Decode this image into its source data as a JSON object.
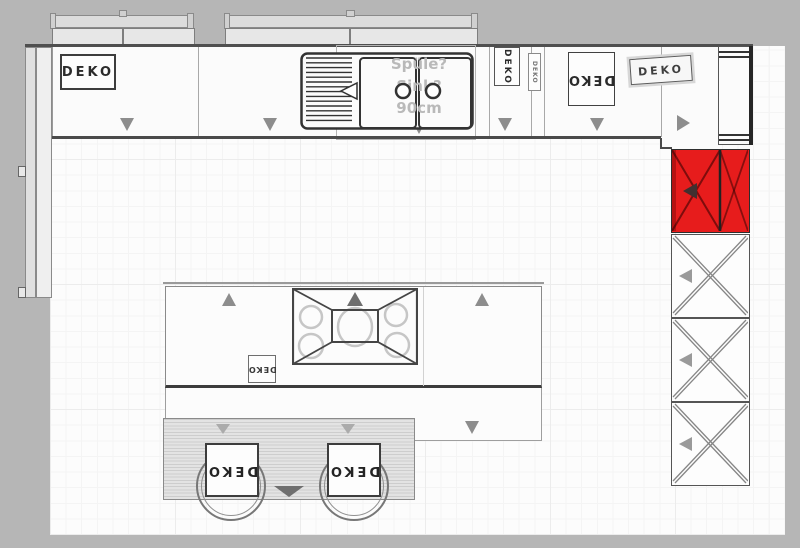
{
  "labels": {
    "deko": "DEKO"
  },
  "annotations": {
    "sink": {
      "line1": "Spüle?",
      "line2": "Sink?",
      "line3": "90cm"
    }
  },
  "colors": {
    "highlight_red": "#e71c1c",
    "exterior_gray": "#b6b6b6",
    "arrow_gray": "#8d8d8d",
    "counter_line": "#4a4a4a"
  }
}
